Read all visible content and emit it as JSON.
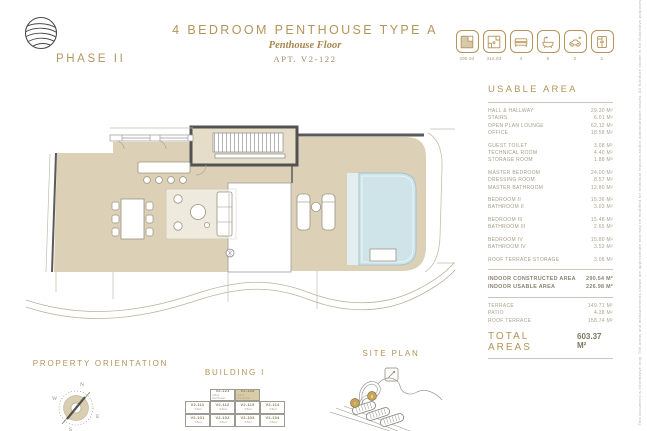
{
  "header": {
    "phase": "PHASE II",
    "title": "4 BEDROOM PENTHOUSE TYPE A",
    "subtitle": "Penthouse Floor",
    "apt": "APT. V2-122",
    "spec_icons": [
      {
        "icon": "constructed-area-icon",
        "label": "290.54"
      },
      {
        "icon": "terrace-area-icon",
        "label": "312.83"
      },
      {
        "icon": "bedrooms-icon",
        "label": "4"
      },
      {
        "icon": "bathrooms-icon",
        "label": "5"
      },
      {
        "icon": "parking-icon",
        "label": "2"
      },
      {
        "icon": "storage-icon",
        "label": "1"
      }
    ]
  },
  "area_table": {
    "title": "USABLE AREA",
    "groups": [
      [
        {
          "label": "HALL & HALLWAY",
          "value": "29.30 M²"
        },
        {
          "label": "STAIRS",
          "value": "6.01 M²"
        },
        {
          "label": "OPEN PLAN LOUNGE",
          "value": "62.12 M²"
        },
        {
          "label": "OFFICE",
          "value": "18.58 M²"
        }
      ],
      [
        {
          "label": "GUEST TOILET",
          "value": "3.08 M²"
        },
        {
          "label": "TECHNICAL ROOM",
          "value": "4.40 M²"
        },
        {
          "label": "STORAGE ROOM",
          "value": "1.88 M²"
        }
      ],
      [
        {
          "label": "MASTER BEDROOM",
          "value": "24.00 M²"
        },
        {
          "label": "DRESSING ROOM",
          "value": "8.57 M²"
        },
        {
          "label": "MASTER BATHROOM",
          "value": "12.80 M²"
        }
      ],
      [
        {
          "label": "BEDROOM II",
          "value": "15.36 M²"
        },
        {
          "label": "BATHROOM II",
          "value": "3.03 M²"
        }
      ],
      [
        {
          "label": "BEDROOM III",
          "value": "15.48 M²"
        },
        {
          "label": "BATHROOM III",
          "value": "2.65 M²"
        }
      ],
      [
        {
          "label": "BEDROOM IV",
          "value": "15.80 M²"
        },
        {
          "label": "BATHROOM IV",
          "value": "3.52 M²"
        }
      ],
      [
        {
          "label": "ROOF TERRACE STORAGE",
          "value": "3.08 M²"
        }
      ]
    ],
    "summary": [
      {
        "label": "INDOOR CONSTRUCTED AREA",
        "value": "290.54 M²"
      },
      {
        "label": "INDOOR USABLE AREA",
        "value": "226.98 M²"
      }
    ],
    "terrace_rows": [
      {
        "label": "TERRACE",
        "value": "149.71 M²"
      },
      {
        "label": "PATIO",
        "value": "4.38 M²"
      },
      {
        "label": "ROOF TERRACE",
        "value": "158.74 M²"
      }
    ],
    "total_label": "TOTAL AREAS",
    "total_value": "603.37 M²"
  },
  "footer": {
    "orientation": {
      "title": "PROPERTY ORIENTATION",
      "cardinal": {
        "n": "N",
        "w": "W",
        "e": "E",
        "s": "S"
      }
    },
    "building": {
      "title": "BUILDING I",
      "penthouse_row": [
        {
          "code": "V2-121",
          "sub": "4 Bed Penthouse",
          "highlight": false
        },
        {
          "code": "V2-122",
          "sub": "4 Bed Penthouse",
          "highlight": true
        }
      ],
      "floor_rows": [
        [
          {
            "code": "V2-111",
            "sub": "3 Bed"
          },
          {
            "code": "V2-112",
            "sub": "3 Bed"
          },
          {
            "code": "V2-113",
            "sub": "3 Bed"
          },
          {
            "code": "V2-114",
            "sub": "3 Bed"
          }
        ],
        [
          {
            "code": "V2-101",
            "sub": "3 Bed"
          },
          {
            "code": "V2-102",
            "sub": "3 Bed"
          },
          {
            "code": "V2-103",
            "sub": "3 Bed"
          },
          {
            "code": "V2-104",
            "sub": "3 Bed"
          }
        ]
      ]
    },
    "site_plan": {
      "title": "SITE PLAN",
      "markers": [
        "I",
        "II"
      ]
    }
  },
  "disclaimer": "This document is informative only. The areas and measurements shown are approximate and may be modified for technical reasons and/or administrative issues. All furniture shown is for illustrative purposes.",
  "colors": {
    "accent_gold": "#b5935a",
    "terrace_beige": "#dcd1b6",
    "pool_blue": "#cfe4e9",
    "wall_dark": "#5a5a5a",
    "table_text": "#a49d89"
  }
}
